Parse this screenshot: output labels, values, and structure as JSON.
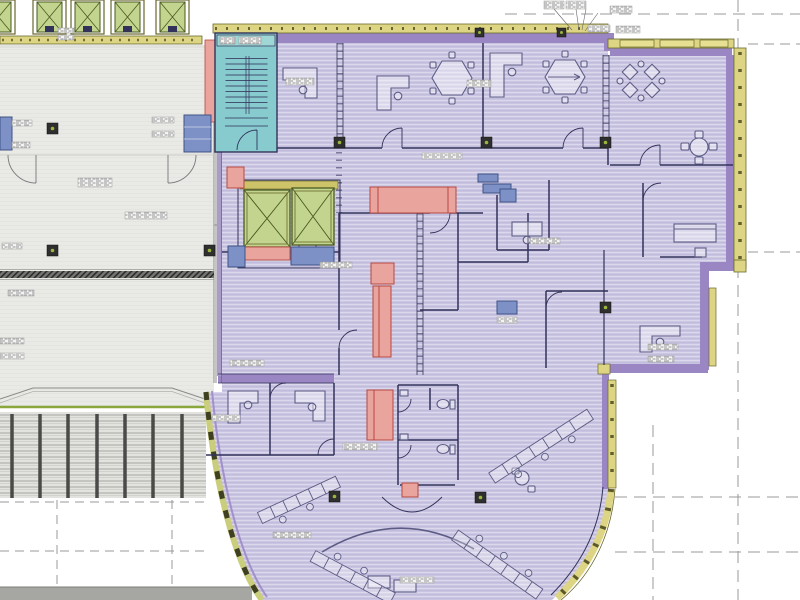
{
  "document": {
    "kind": "scanned-architectural-floor-plan",
    "legible_text": false
  },
  "palette": {
    "bg": "#ffffff",
    "grayZone": "#e9e9e6",
    "grayLine": "#9b9b97",
    "dark": "#32325a",
    "furn": "#5c5c85",
    "purple": "#ccc7e3",
    "purpleStripe": "#b9b2d8",
    "purpleWall": "#9b86c4",
    "yellow": "#ddd584",
    "yellowPier": "#e7df92",
    "olive": "#6a682c",
    "oliveDark": "#44431a",
    "greenElev": "#c2d48e",
    "greenDark": "#4a5a20",
    "teal": "#87cbce",
    "tealHeader": "#9fd6d6",
    "pink": "#eaa49e",
    "pinkDark": "#b5493f",
    "blue": "#7e91c6",
    "blueDark": "#3f5384",
    "hatchBg": "#757572",
    "hatchLine": "#2c2c2c",
    "dockBg": "#e2e2df",
    "dockLine": "#a6a6a2",
    "post": "#4a4a48",
    "greenLine": "#8aa73c",
    "annot": "#9a9a98",
    "labelBg": "#f4f4f2",
    "labelInk": "#77777a",
    "colDark": "#2f2f2f",
    "colDot": "#9ab53c",
    "grayBar": "#a6a6a3"
  },
  "plan": {
    "zones": [
      {
        "name": "existing-core-area",
        "color_key": "grayZone"
      },
      {
        "name": "tenant-office-area",
        "color_key": "purple"
      },
      {
        "name": "stairwell",
        "color_key": "teal"
      },
      {
        "name": "elevator-shafts",
        "color_key": "greenElev"
      },
      {
        "name": "casework-millwork",
        "color_key": "pink"
      },
      {
        "name": "equipment-fixtures",
        "color_key": "blue"
      },
      {
        "name": "exterior-wall",
        "color_key": "yellow"
      },
      {
        "name": "interior-partition",
        "color_key": "purpleWall"
      }
    ],
    "counts": {
      "top_elevator_cars": 5,
      "core_elevator_cars": 2,
      "conference_tables": 2,
      "round_tables": 1,
      "restroom_fixtures": 2,
      "angled_workstation_rows": 4
    }
  }
}
